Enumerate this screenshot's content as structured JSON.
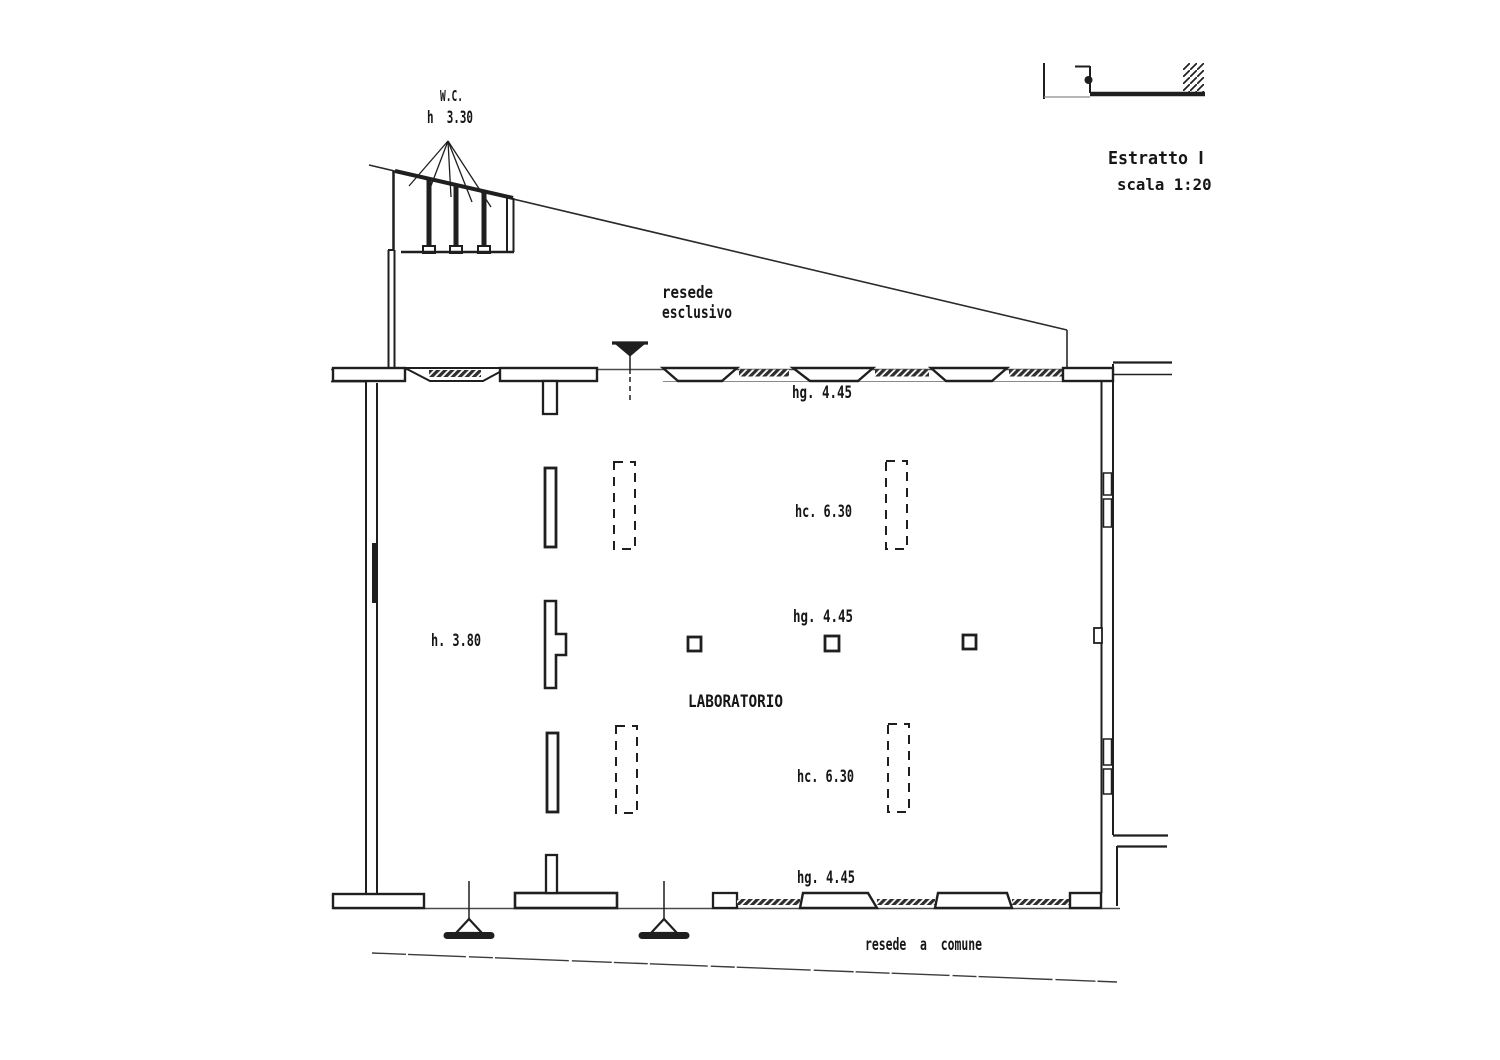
{
  "page": {
    "background": "#ffffff",
    "ink": "#1f1f1f",
    "faint": "#8a8a8a"
  },
  "plan": {
    "title_block": {
      "estratto_label": "Estratto",
      "scala_label": "scala 1:200"
    },
    "wc": {
      "label": "W.C.",
      "height_label": "h  3.30"
    },
    "areas": {
      "resede_esclusivo_line1": "resede",
      "resede_esclusivo_line2": "esclusivo",
      "resede_comune": "resede  a  comune",
      "room": "LABORATORIO"
    },
    "heights": {
      "left": "h. 3.80",
      "hg_top": "hg. 4.45",
      "hc_top": "hc. 6.30",
      "hg_mid": "hg. 4.45",
      "hc_bottom": "hc. 6.30",
      "hg_bottom": "hg. 4.45"
    }
  }
}
